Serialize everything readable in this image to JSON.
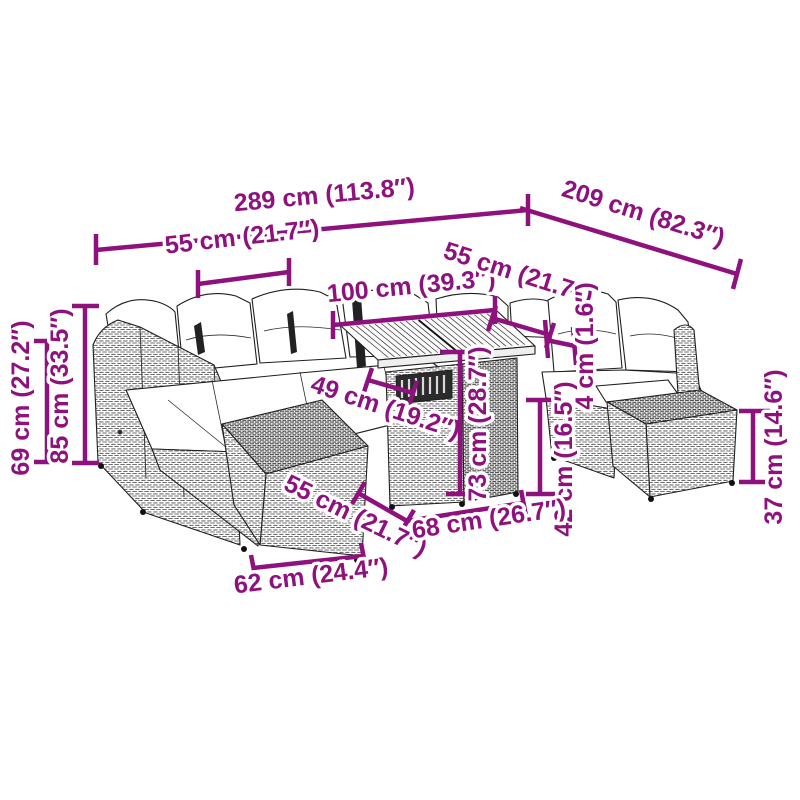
{
  "page": {
    "background": "#ffffff",
    "illustration_alt": "line drawing of a rattan garden lounge set with corner sofa, slatted table, and ottomans"
  },
  "accent_color": "#8E117E",
  "art_colors": {
    "outline": "#1f1f1f",
    "rattan": "#6f6f6f",
    "cushion": "#ffffff"
  },
  "dims": {
    "overall_width": "289 cm (113.8″)",
    "overall_depth": "209 cm (82.3″)",
    "module_width_left": "55 cm (21.7″)",
    "table_top_length": "100 cm (39.3″)",
    "module_width_back": "55 cm (21.7″)",
    "table_clearance": "49 cm (19.2″)",
    "table_height": "73 cm (28.7″)",
    "top_thickness": "4 cm (1.6″)",
    "seat_height": "42 cm (16.5″)",
    "back_height_outer": "69 cm (27.2″)",
    "back_height_total": "85 cm (33.5″)",
    "ottoman_height": "37 cm (14.6″)",
    "module_width_front": "55 cm (21.7″)",
    "table_base_length": "68 cm (26.7″)",
    "ottoman_width": "62 cm (24.4″)"
  }
}
